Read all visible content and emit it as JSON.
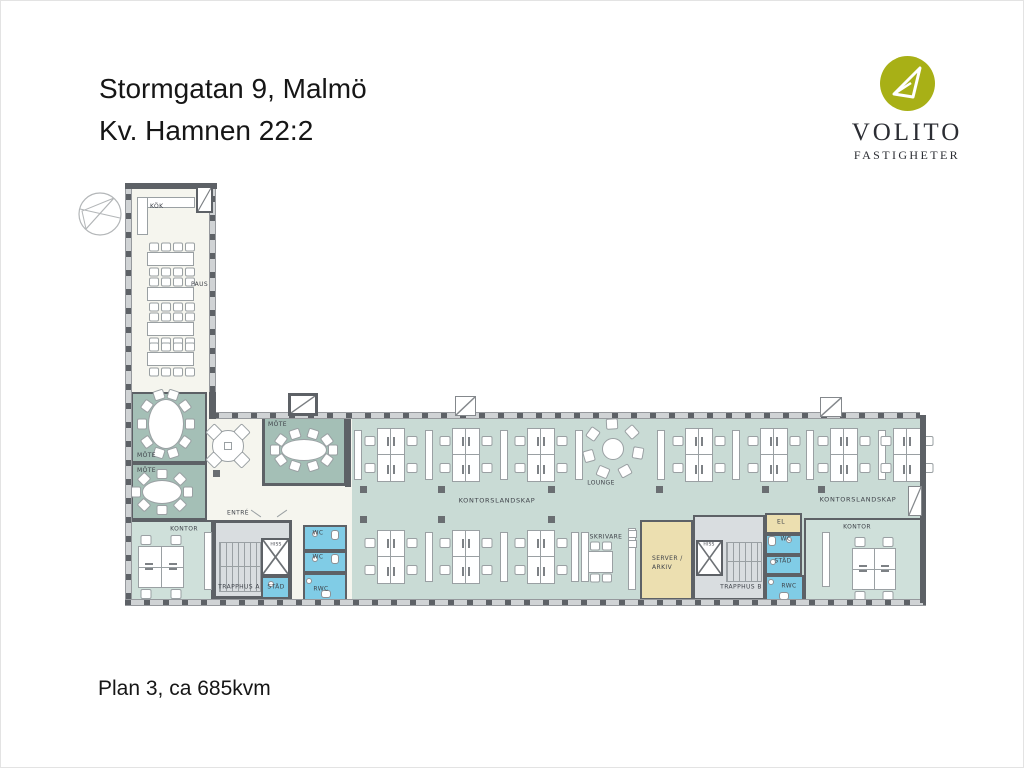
{
  "title": {
    "line1": "Stormgatan 9, Malmö",
    "line2": "Kv. Hamnen 22:2"
  },
  "footer": {
    "caption": "Plan 3, ca 685kvm"
  },
  "logo": {
    "name": "VOLITO",
    "subtitle": "FASTIGHETER",
    "brand_color": "#a8b016",
    "glyph": "paper-plane"
  },
  "floorplan": {
    "labels": {
      "kok": "KÖK",
      "paus": "PAUS",
      "mote": "MÖTE",
      "kontor": "KONTOR",
      "entre": "ENTRÉ",
      "trapphus_a": "TRAPPHUS A",
      "trapphus_b": "TRAPPHUS B",
      "stad": "STÄD",
      "wc": "WC",
      "rwc": "RWC",
      "hiss": "HISS",
      "el": "EL",
      "kontorslandskap": "KONTORSLANDSKAP",
      "lounge": "LOUNGE",
      "skrivare": "SKRIVARE",
      "server_line1": "SERVER /",
      "server_line2": "ARKIV"
    },
    "colors": {
      "wall": "#5d6166",
      "floor": "#f5f5ee",
      "meeting": "#a4bfb6",
      "openplan": "#c9dbd5",
      "office": "#cfe0da",
      "wet": "#80cce6",
      "technical": "#ecdfb0",
      "stairwell": "#d9dde0"
    }
  }
}
